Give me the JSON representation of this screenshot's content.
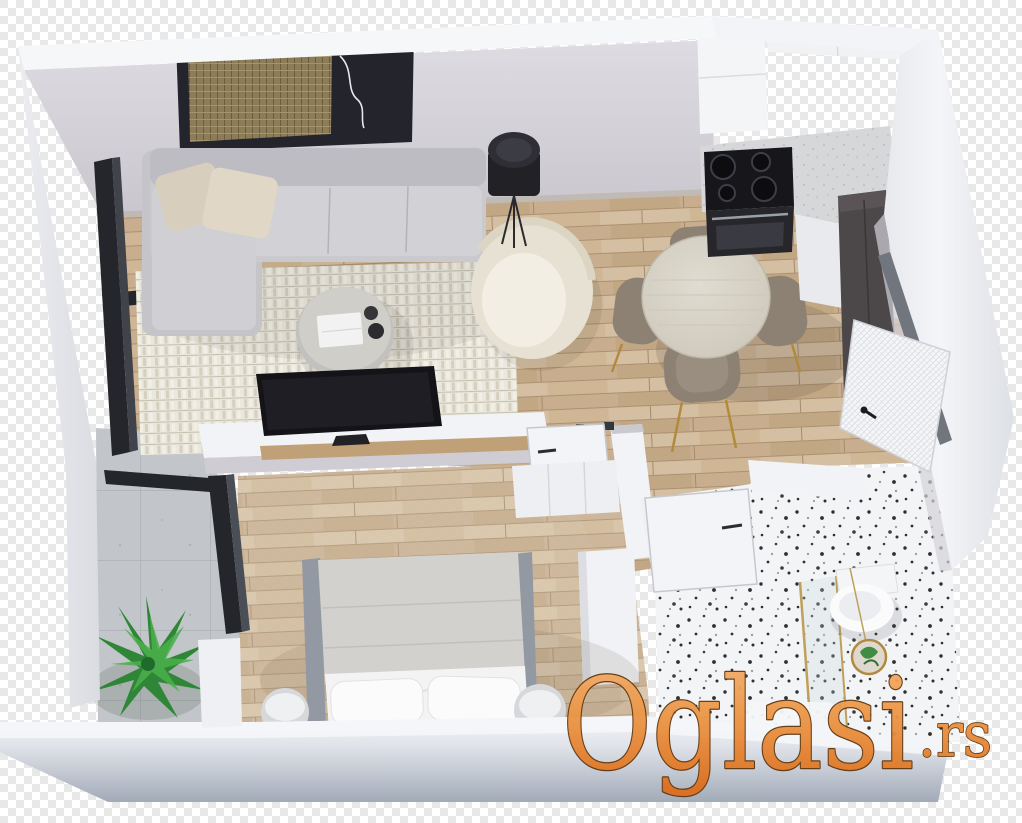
{
  "meta": {
    "description": "Isometric 3D rendered floor plan of a one-bedroom apartment on a transparent checkerboard background",
    "image_kind": "3d-floor-plan-render"
  },
  "watermark": {
    "text": "Oglasi",
    "suffix": ".rs",
    "fill_top": "#f4b272",
    "fill_mid": "#ec9747",
    "fill_bottom": "#dd6e1c",
    "outline": "#5f3710"
  },
  "background": {
    "checker_light": "#ffffff",
    "checker_dark": "#e8e8e8"
  },
  "palette": {
    "wall_top": "#f6f7f9",
    "wall_face": "#d3d1d8",
    "wall_front": "#a8b0bd",
    "wood_floor": "#cdb596",
    "bedroom_floor": "#d5c1a4",
    "balcony_floor": "#c2c6ca",
    "terrazzo": "#f3f4f6",
    "sofa": "#c9c9ce",
    "pillow_beige": "#d8cebd",
    "rug": "#eae7dc",
    "tv_black": "#16161a",
    "armchair_cream": "#e7e1d3",
    "dining_table": "#d9d4c9",
    "chair_taupe": "#8d8174",
    "chair_leg_gold": "#b28a3c",
    "cooktop_black": "#17171b",
    "dark_cabinet": "#4c484a",
    "plant_green": "#2e8636",
    "bed_gray": "#d3d1cd",
    "sheet_white": "#f3f3f4"
  },
  "rooms": [
    {
      "name": "living-room",
      "furniture": [
        "corner-sofa",
        "throw-pillows",
        "area-rug",
        "round-coffee-table",
        "book",
        "cups",
        "tv",
        "tv-console",
        "wall-art",
        "floor-lamp",
        "armchair"
      ]
    },
    {
      "name": "dining-area",
      "furniture": [
        "round-dining-table",
        "dining-chair",
        "dining-chair",
        "dining-chair",
        "dining-chair"
      ]
    },
    {
      "name": "kitchen",
      "furniture": [
        "upper-cabinets",
        "l-shaped-counter",
        "cooktop",
        "oven",
        "tall-dark-cabinet"
      ]
    },
    {
      "name": "hallway",
      "furniture": [
        "entrance-door"
      ]
    },
    {
      "name": "bedroom",
      "furniture": [
        "double-bed",
        "bed-pillows",
        "nightstand",
        "nightstand",
        "wardrobe",
        "dresser",
        "bedroom-door"
      ]
    },
    {
      "name": "bathroom",
      "furniture": [
        "toilet",
        "shower-glass-screen",
        "gold-plant-pot",
        "bathroom-door"
      ]
    },
    {
      "name": "balcony",
      "furniture": [
        "potted-plant",
        "glass-door-frame"
      ]
    }
  ]
}
